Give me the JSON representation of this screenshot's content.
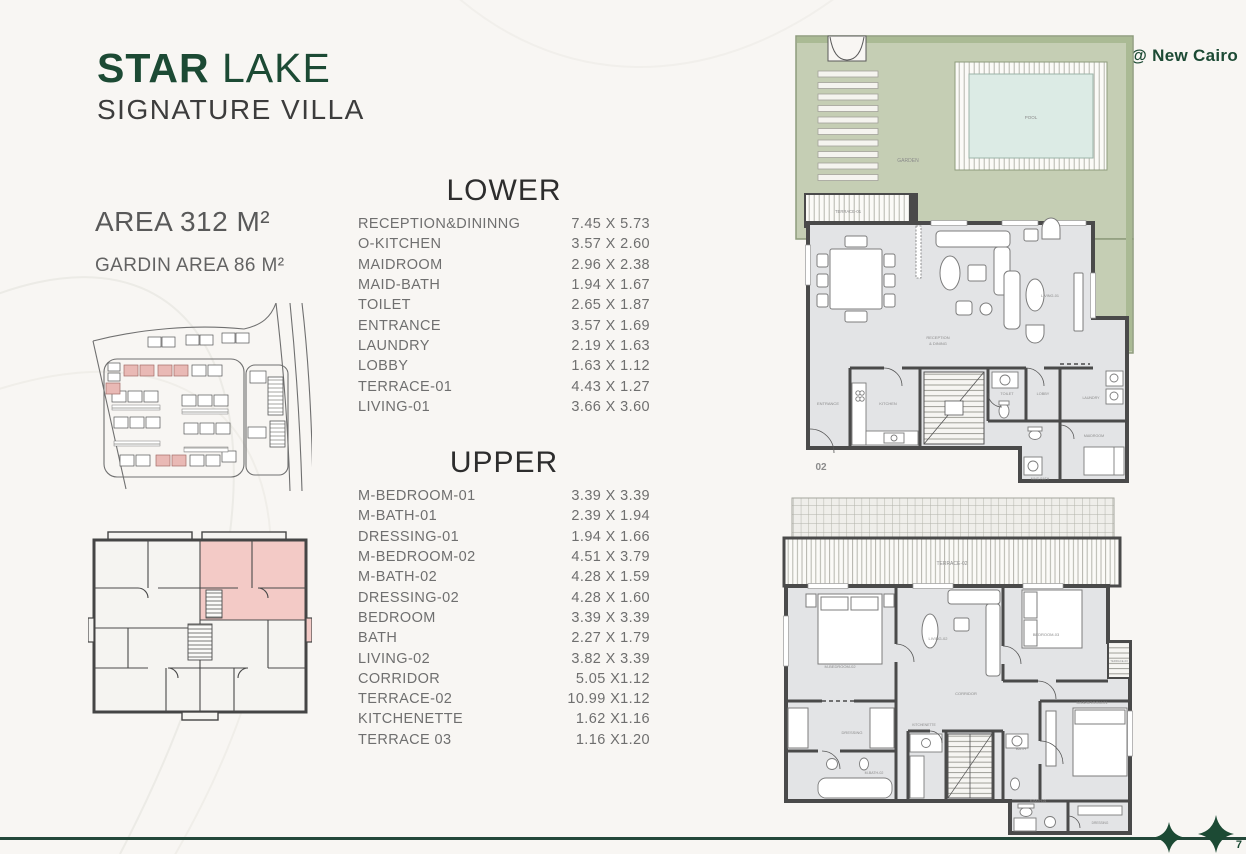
{
  "header": {
    "title_bold": "STAR",
    "title_light": "LAKE",
    "subtitle": "SIGNATURE VILLA",
    "location": "@ New Cairo"
  },
  "specs": {
    "area": "AREA 312 M²",
    "garden_area": "GARDIN AREA 86 M²"
  },
  "lower_table": {
    "heading": "LOWER",
    "rows": [
      {
        "room": "RECEPTION&DININNG",
        "dim": "7.45 X 5.73"
      },
      {
        "room": "O-KITCHEN",
        "dim": "3.57 X 2.60"
      },
      {
        "room": "MAIDROOM",
        "dim": "2.96 X 2.38"
      },
      {
        "room": "MAID-BATH",
        "dim": "1.94 X 1.67"
      },
      {
        "room": "TOILET",
        "dim": "2.65 X 1.87"
      },
      {
        "room": "ENTRANCE",
        "dim": "3.57 X 1.69"
      },
      {
        "room": "LAUNDRY",
        "dim": "2.19 X 1.63"
      },
      {
        "room": "LOBBY",
        "dim": "1.63 X 1.12"
      },
      {
        "room": "TERRACE-01",
        "dim": "4.43 X 1.27"
      },
      {
        "room": "LIVING-01",
        "dim": "3.66 X 3.60"
      }
    ]
  },
  "upper_table": {
    "heading": "UPPER",
    "rows": [
      {
        "room": "M-BEDROOM-01",
        "dim": "3.39 X 3.39"
      },
      {
        "room": "M-BATH-01",
        "dim": "2.39 X 1.94"
      },
      {
        "room": "DRESSING-01",
        "dim": "1.94 X 1.66"
      },
      {
        "room": "M-BEDROOM-02",
        "dim": "4.51 X 3.79"
      },
      {
        "room": "M-BATH-02",
        "dim": "4.28 X 1.59"
      },
      {
        "room": "DRESSING-02",
        "dim": "4.28 X 1.60"
      },
      {
        "room": "BEDROOM",
        "dim": "3.39 X 3.39"
      },
      {
        "room": "BATH",
        "dim": "2.27 X 1.79"
      },
      {
        "room": "LIVING-02",
        "dim": "3.82 X 3.39"
      },
      {
        "room": "CORRIDOR",
        "dim": "5.05 X1.12"
      },
      {
        "room": "TERRACE-02",
        "dim": "10.99 X1.12"
      },
      {
        "room": "KITCHENETTE",
        "dim": "1.62 X1.16"
      },
      {
        "room": "TERRACE 03",
        "dim": "1.16 X1.20"
      }
    ]
  },
  "lower_plan": {
    "garden": "GARDEN",
    "pool": "POOL",
    "terrace": "TERRACE-01",
    "reception_line1": "RECEPTION",
    "reception_line2": "& DINING",
    "entrance": "ENTRANCE",
    "kitchen": "KITCHEN",
    "toilet": "TOILET",
    "lobby": "LOBBY",
    "laundry": "LAUNDRY",
    "maidroom": "MAIDROOM",
    "maid_bath": "MAID-BATH",
    "living": "LIVING-01",
    "unit_number": "02"
  },
  "upper_plan": {
    "terrace2": "TERRACE-02",
    "m_bedroom2": "M-BEDROOM-02",
    "living2": "LIVING-02",
    "bedroom3": "BEDROOM-03",
    "terrace3": "TERRACE-03",
    "corridor": "CORRIDOR",
    "m_bedroom1": "M-BEDROOM-01",
    "kitchenette": "KITCHENETTE",
    "bath": "BATH",
    "dressing_left": "DRESSING",
    "m_bath2": "M-BATH-02",
    "m_bath1": "M-BATH-01",
    "dressing_right": "DRESSING"
  },
  "footer": {
    "page_number": "7"
  },
  "colors": {
    "brand_green": "#1c4a34",
    "line_green": "#24483a",
    "garden_green": "#c5ceb4",
    "pool_blue": "#dcebe5",
    "highlight_pink": "#f3cac6",
    "unit_red": "#c0504d",
    "wall_gray": "#4a4a4a",
    "floor_gray": "#e3e4e6"
  }
}
